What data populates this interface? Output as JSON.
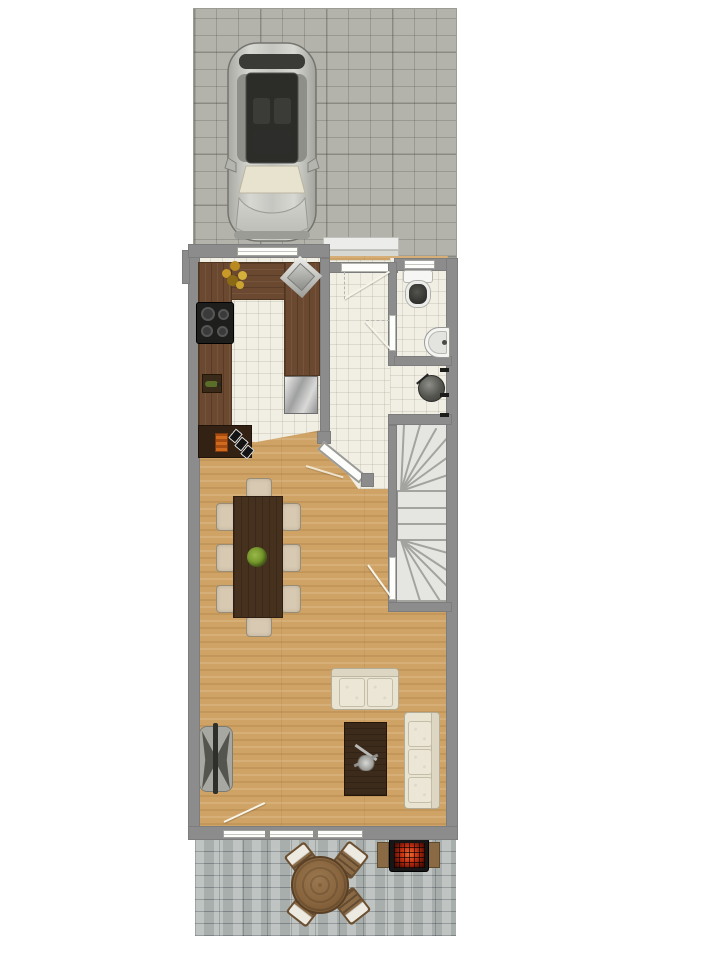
{
  "scene": {
    "kind": "architectural-floor-plan",
    "view": "top-down ground floor of a narrow row house with driveway and rear patio",
    "visible_text": []
  },
  "palette": {
    "wall": "#8c8c8c",
    "paver": "#b3b3ab",
    "cobble": "#b5bbb8",
    "tile": "#f1eee4",
    "wood": "#cfa365",
    "counter": "#6b4930",
    "dtable": "#46311f",
    "sofa": "#e9e3d1",
    "chair": "#d8cab2",
    "stair": "#e5e5e2",
    "window": "#fdfdfb",
    "fire": "#cc3912",
    "plant": "#76982c",
    "car_silver": "#c9c9c4",
    "glass_dark": "#2c2c29"
  },
  "areas": [
    {
      "id": "driveway",
      "surface": "gray concrete pavers"
    },
    {
      "id": "entry-porch",
      "surface": "two concrete steps"
    },
    {
      "id": "kitchen",
      "surface": "white tile, U-shaped dark wood counter"
    },
    {
      "id": "hallway",
      "surface": "white tile"
    },
    {
      "id": "wc-bathroom",
      "surface": "white tile"
    },
    {
      "id": "utility-nook",
      "surface": "white tile"
    },
    {
      "id": "stairwell",
      "surface": "U-shaped winder staircase"
    },
    {
      "id": "living-dining-room",
      "surface": "light wood plank floor"
    },
    {
      "id": "patio",
      "surface": "blue-gray cobblestone"
    }
  ],
  "furniture": [
    {
      "id": "car",
      "area": "driveway",
      "count": 1
    },
    {
      "id": "cooktop-4-burners",
      "area": "kitchen",
      "count": 1
    },
    {
      "id": "kitchen-sink-diagonal",
      "area": "kitchen",
      "count": 1
    },
    {
      "id": "flower-vase",
      "area": "kitchen",
      "count": 1
    },
    {
      "id": "wine-bottle-holder",
      "area": "kitchen",
      "count": 1
    },
    {
      "id": "dishwasher-front",
      "area": "kitchen",
      "count": 1
    },
    {
      "id": "sideboard-with-decor",
      "area": "kitchen",
      "count": 1
    },
    {
      "id": "dining-table",
      "area": "living-dining-room",
      "count": 1
    },
    {
      "id": "dining-chair",
      "area": "living-dining-room",
      "count": 8
    },
    {
      "id": "table-plant-centerpiece",
      "area": "living-dining-room",
      "count": 1
    },
    {
      "id": "tv-on-stand",
      "area": "living-dining-room",
      "count": 1
    },
    {
      "id": "loveseat-2-seat",
      "area": "living-dining-room",
      "count": 1
    },
    {
      "id": "sofa-3-seat",
      "area": "living-dining-room",
      "count": 1
    },
    {
      "id": "coffee-table-with-decor",
      "area": "living-dining-room",
      "count": 1
    },
    {
      "id": "toilet",
      "area": "wc-bathroom",
      "count": 1
    },
    {
      "id": "washbasin",
      "area": "wc-bathroom",
      "count": 1
    },
    {
      "id": "boiler-tank",
      "area": "utility-nook",
      "count": 1
    },
    {
      "id": "radiator-marks",
      "area": "utility-nook",
      "count": 3
    },
    {
      "id": "round-patio-table",
      "area": "patio",
      "count": 1
    },
    {
      "id": "patio-chair",
      "area": "patio",
      "count": 4
    },
    {
      "id": "bbq-grill-with-side-shelves",
      "area": "patio",
      "count": 1
    }
  ],
  "openings": [
    {
      "id": "front-door",
      "wall": "hallway-top"
    },
    {
      "id": "kitchen-window",
      "wall": "kitchen-top"
    },
    {
      "id": "bathroom-window",
      "wall": "bathroom-top"
    },
    {
      "id": "bathroom-door",
      "wall": "hall-bath-divider"
    },
    {
      "id": "diagonal-kitchen-door",
      "wall": "hall-living-diagonal"
    },
    {
      "id": "stair-door",
      "wall": "stair-left"
    },
    {
      "id": "patio-door-and-windows",
      "wall": "living-bottom"
    }
  ]
}
